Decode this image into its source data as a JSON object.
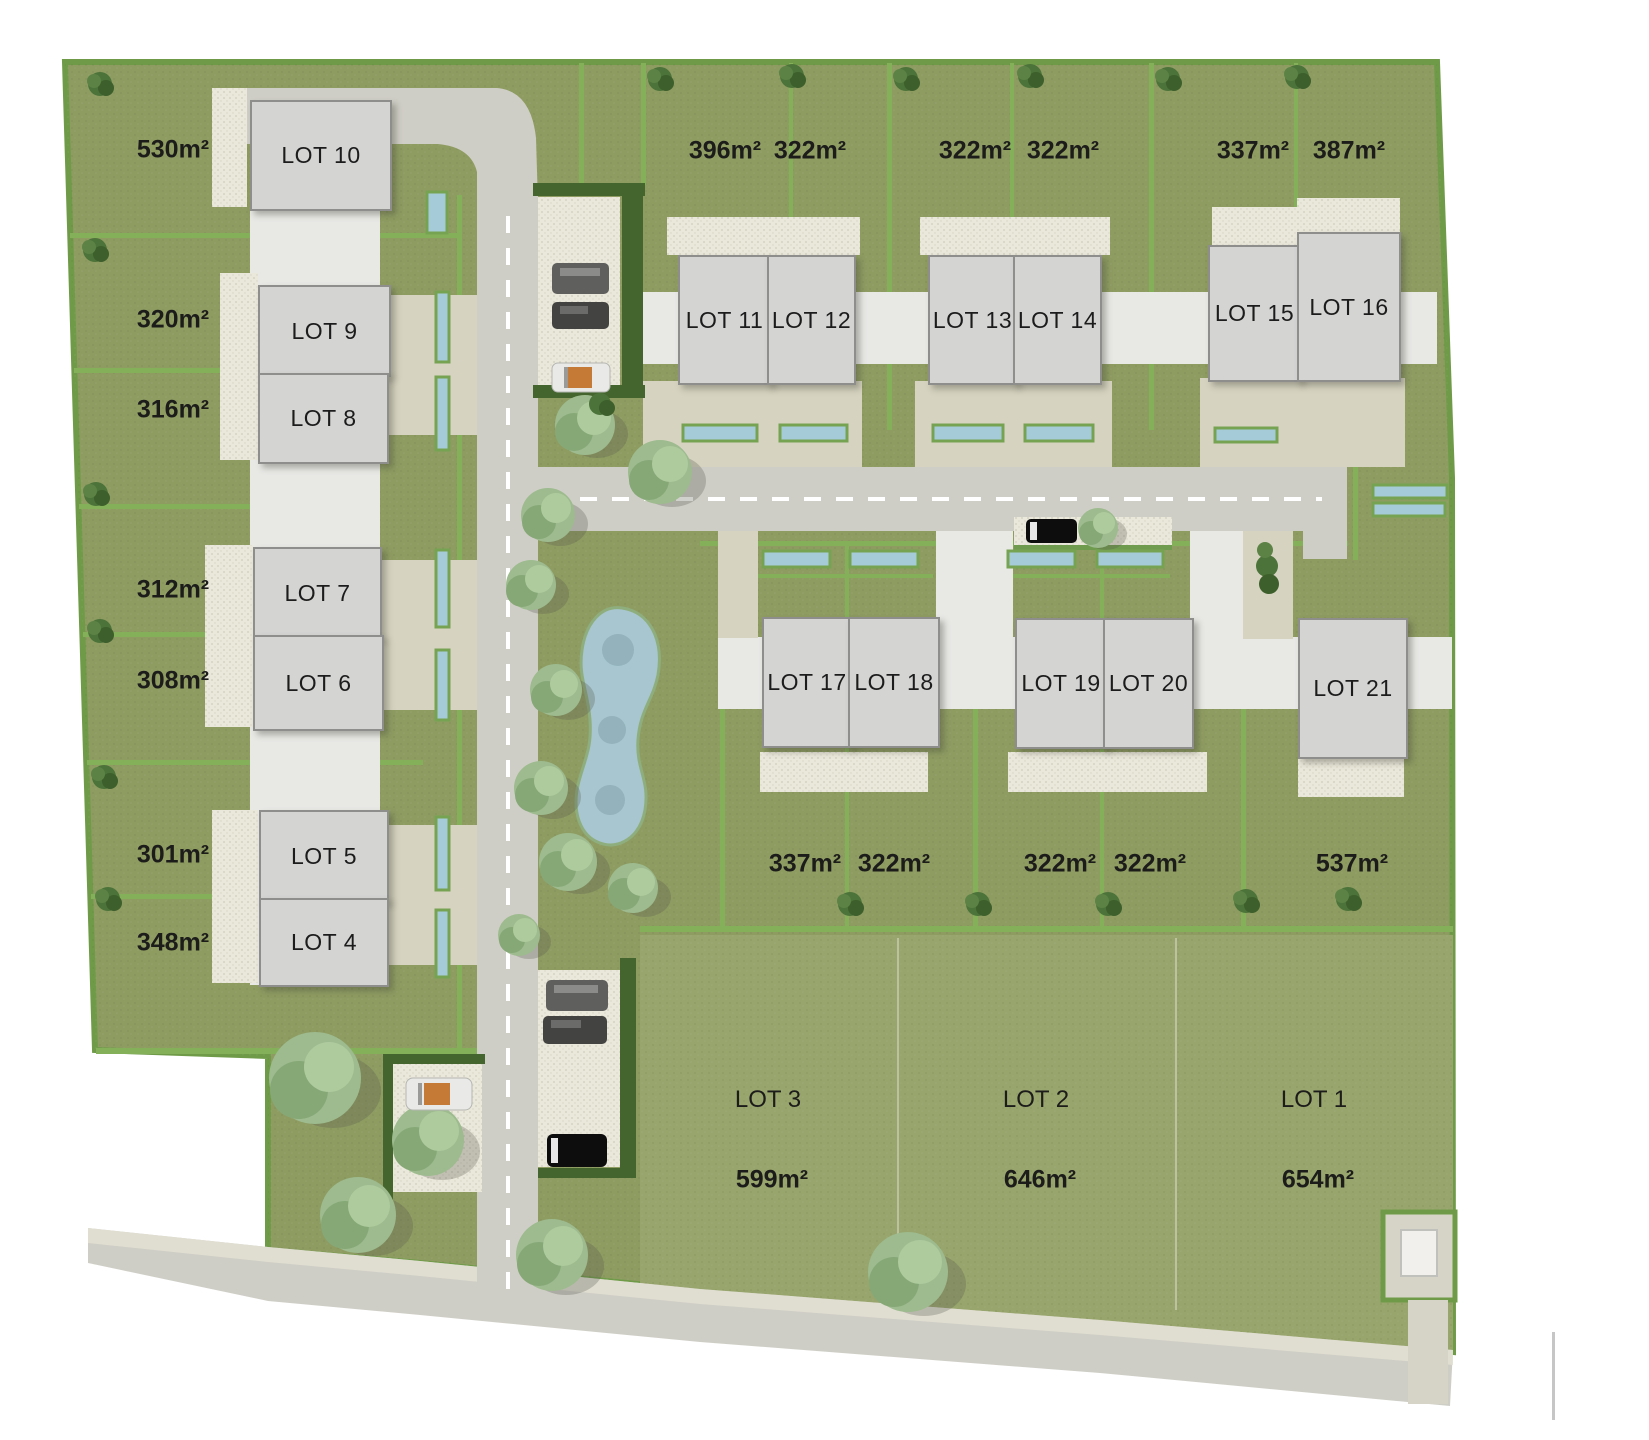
{
  "plan_type": "residential subdivision site plan",
  "lots": [
    {
      "label": "LOT 1",
      "area": "654m²"
    },
    {
      "label": "LOT 2",
      "area": "646m²"
    },
    {
      "label": "LOT 3",
      "area": "599m²"
    },
    {
      "label": "LOT 4",
      "area": "348m²"
    },
    {
      "label": "LOT 5",
      "area": "301m²"
    },
    {
      "label": "LOT 6",
      "area": "308m²"
    },
    {
      "label": "LOT 7",
      "area": "312m²"
    },
    {
      "label": "LOT 8",
      "area": "316m²"
    },
    {
      "label": "LOT 9",
      "area": "320m²"
    },
    {
      "label": "LOT 10",
      "area": "530m²"
    },
    {
      "label": "LOT 11",
      "area": "396m²"
    },
    {
      "label": "LOT 12",
      "area": "322m²"
    },
    {
      "label": "LOT 13",
      "area": "322m²"
    },
    {
      "label": "LOT 14",
      "area": "322m²"
    },
    {
      "label": "LOT 15",
      "area": "337m²"
    },
    {
      "label": "LOT 16",
      "area": "387m²"
    },
    {
      "label": "LOT 17",
      "area": "337m²"
    },
    {
      "label": "LOT 18",
      "area": "322m²"
    },
    {
      "label": "LOT 19",
      "area": "322m²"
    },
    {
      "label": "LOT 20",
      "area": "322m²"
    },
    {
      "label": "LOT 21",
      "area": "537m²"
    }
  ],
  "colors": {
    "background": "#ffffff",
    "grass": "#8e9c62",
    "grass_light": "#98a56c",
    "hedge": "#85b05a",
    "hedge_dark": "#44662e",
    "road": "#cfcec6",
    "corridor": "#e8e8e5",
    "driveway": "#d6d3c0",
    "paving": "#eae8da",
    "house_fill": "#d4d4d3",
    "house_border": "#8e8e8c",
    "pool_water": "#a5cbd8",
    "pond_water": "#a7c6cf",
    "tree": "#9dbb8e",
    "label_text": "#1c1c1a"
  }
}
